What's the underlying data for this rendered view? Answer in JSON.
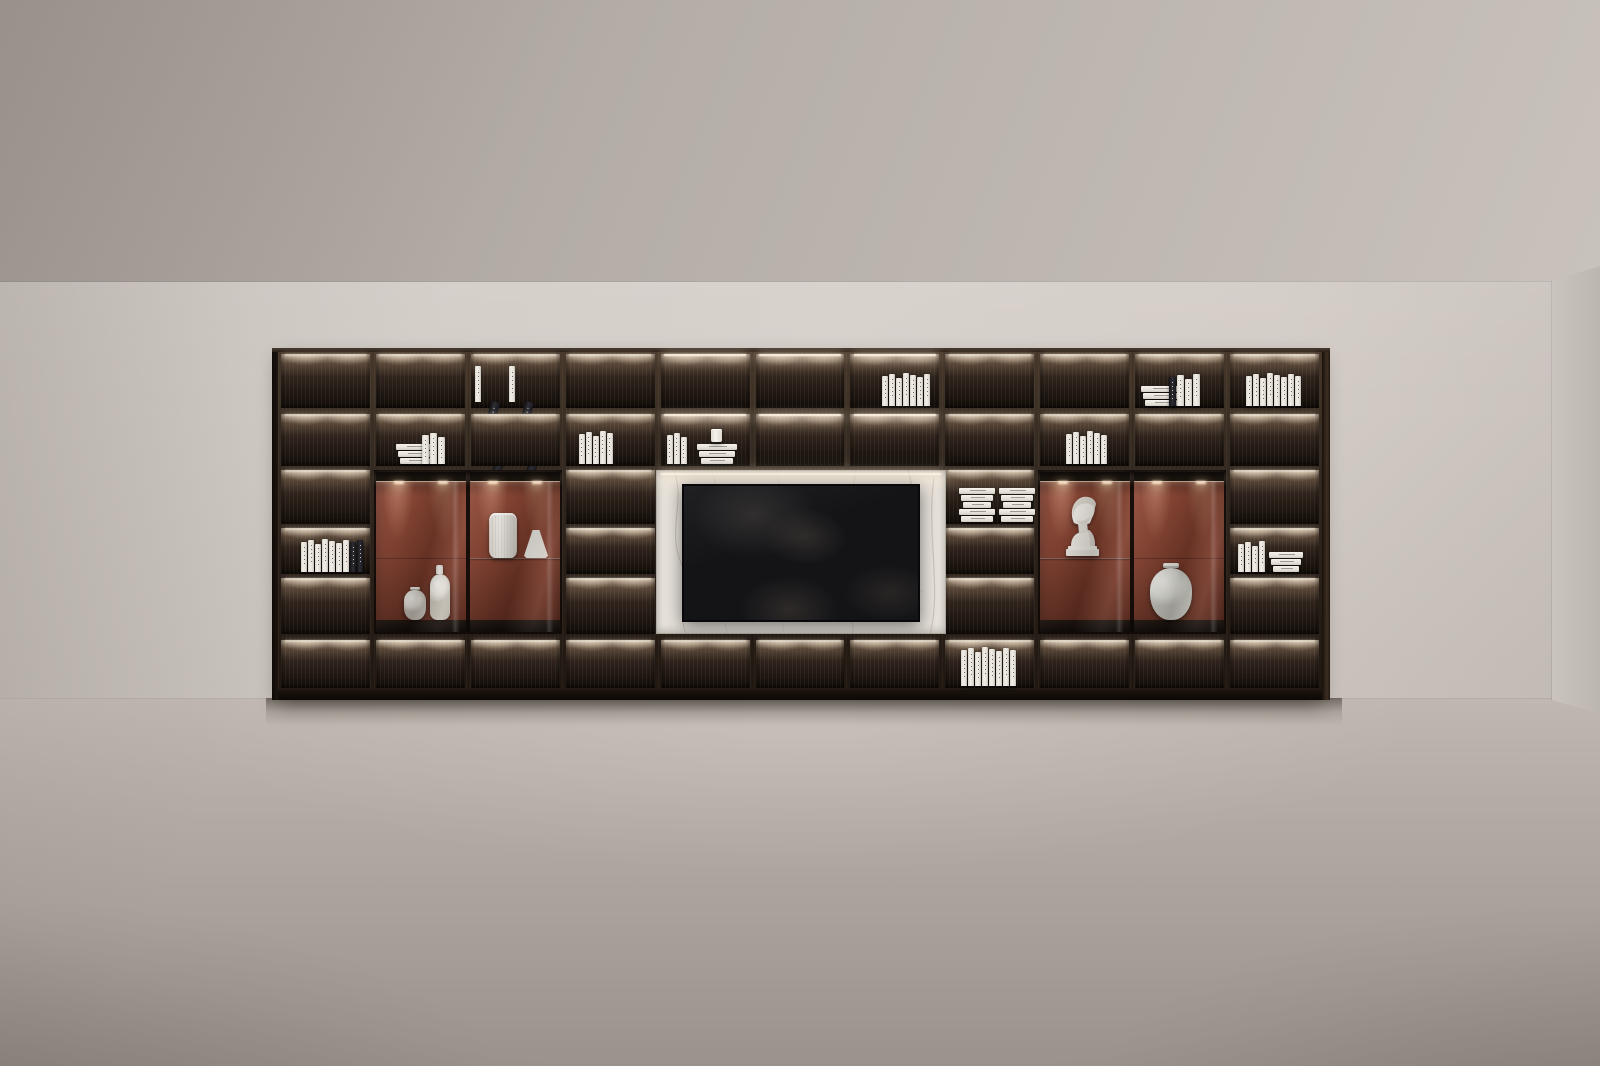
{
  "scene": {
    "title": "Dark wood shelving media wall with lit compartments in an empty room",
    "type": "3d-interior-render"
  },
  "palette": {
    "ceiling_top": "#a39b95",
    "ceiling_bottom": "#c9c2bc",
    "wall": "#d4cec8",
    "side_wall": "#c5beb8",
    "floor_far": "#bcb4ac",
    "floor_near": "#9b938b",
    "wood_frame": "#342a21",
    "cell_back_dark": "#140e09",
    "led_warm": "#fff4e4",
    "terracotta": "#8a4330",
    "terracotta_dark": "#5e2b1e",
    "marble": "#e7e2db",
    "marble_vein": "#a4988a",
    "tv_screen": "#141417",
    "book_white": "#f2efe8",
    "book_dark": "#232227",
    "ceramic": "#f3f0ea"
  },
  "shelf": {
    "columns": 11,
    "book_columns": [
      1,
      4,
      8,
      11
    ],
    "cabinet_columns": [
      [
        2,
        3
      ],
      [
        9,
        10
      ]
    ],
    "tv_columns": [
      5,
      6,
      7
    ],
    "bright_cells": [
      [
        5,
        1
      ],
      [
        6,
        1
      ],
      [
        7,
        1
      ],
      [
        5,
        2
      ],
      [
        6,
        2
      ],
      [
        7,
        2
      ]
    ],
    "contents": [
      {
        "col": 3,
        "row": 1,
        "kind": "leaning-clusters",
        "clusters": 2,
        "x": 4
      },
      {
        "col": 7,
        "row": 1,
        "kind": "standing",
        "count": 7,
        "x": 32
      },
      {
        "col": 10,
        "row": 1,
        "kind": "stack-standing",
        "stack": 3,
        "stack_w": 40,
        "standing": 4,
        "dark_first": true,
        "x": 6
      },
      {
        "col": 11,
        "row": 1,
        "kind": "standing",
        "count": 8,
        "x": 16
      },
      {
        "col": 2,
        "row": 2,
        "kind": "stack-standing",
        "stack": 3,
        "stack_w": 38,
        "standing": 3,
        "x": 20
      },
      {
        "col": 4,
        "row": 2,
        "kind": "standing",
        "count": 5,
        "x": 13
      },
      {
        "col": 5,
        "row": 2,
        "kind": "standing-stack-cup",
        "standing": 3,
        "stack": 3,
        "stack_w": 40,
        "x": 6
      },
      {
        "col": 9,
        "row": 2,
        "kind": "standing",
        "count": 6,
        "x": 26
      },
      {
        "col": 8,
        "row": 3,
        "kind": "bundles",
        "stacks": 2,
        "slabs": 5,
        "x": 14
      },
      {
        "col": 1,
        "row": 4,
        "kind": "standing-darkend",
        "count": 7,
        "dark": 2,
        "x": 20
      },
      {
        "col": 11,
        "row": 4,
        "kind": "standing-stack",
        "standing": 4,
        "stack": 3,
        "stack_w": 34,
        "x": 8
      },
      {
        "col": 8,
        "row": 6,
        "kind": "standing",
        "count": 8,
        "h": 36,
        "x": 16
      }
    ]
  },
  "cabinets": {
    "left": {
      "back": "terracotta",
      "doors": [
        {
          "level": "floor",
          "items": [
            {
              "kind": "vase-small",
              "x": 30
            },
            {
              "kind": "vase-tall",
              "x": 56
            }
          ]
        },
        {
          "level": "shelf",
          "shelf_y": 88,
          "items": [
            {
              "kind": "vase-cylinder",
              "x": 115
            },
            {
              "kind": "lamp-cone",
              "x": 150
            }
          ]
        }
      ]
    },
    "right": {
      "back": "terracotta",
      "doors": [
        {
          "level": "shelf",
          "shelf_y": 88,
          "items": [
            {
              "kind": "bust",
              "x": 24
            }
          ]
        },
        {
          "level": "floor",
          "items": [
            {
              "kind": "jar",
              "x": 112
            }
          ]
        }
      ]
    }
  },
  "media": {
    "panel": "marble",
    "tv_on": false,
    "led_strip": true
  }
}
